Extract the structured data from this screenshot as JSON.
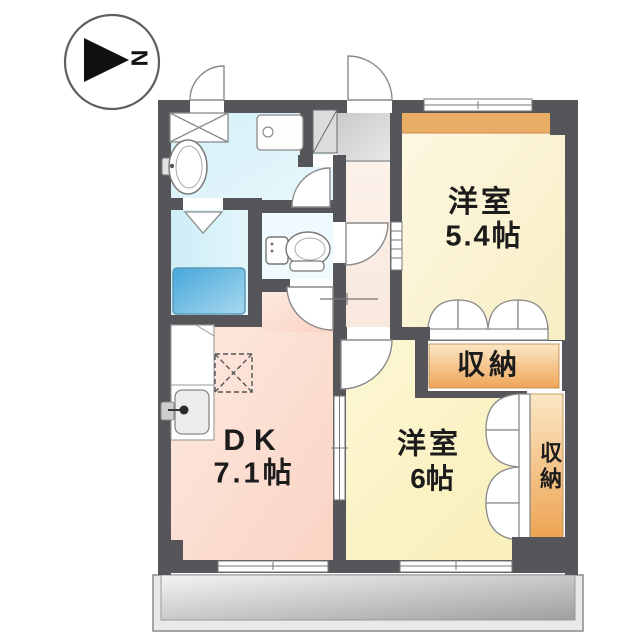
{
  "plan_type": "apartment-floor-plan",
  "compass": {
    "north_label": "N"
  },
  "rooms": {
    "western_room_a": {
      "name": "洋室",
      "size": "5.4帖"
    },
    "western_room_b": {
      "name": "洋室",
      "size": "6帖"
    },
    "dining_kitchen": {
      "name": "DK",
      "size": "7.1帖"
    },
    "storage_between": {
      "label": "収納"
    },
    "storage_side": {
      "label": "収納"
    }
  },
  "fixtures": [
    "bathtub",
    "washbasin",
    "toilet",
    "washing-machine-pan",
    "kitchen-sink",
    "refrigerator-space",
    "shoe-cabinet",
    "closet-x"
  ],
  "colors": {
    "wall": "#56565a",
    "washroom_floor": "#d9f1f8",
    "bath_floor": "#d2eef6",
    "toilet_floor": "#eefafd",
    "dk_floor": "#fbdcce",
    "room_a_floor": "#fbf4d8",
    "room_b_floor": "#fbf2c6",
    "hall_floor": "#fbf0e8",
    "entrance_floor": "#d6d6d6",
    "accent_band": "#e9ad66",
    "storage_orange": "#f0a95c",
    "bathtub_blue": "#55aedd",
    "balcony_gray": "#c9c9c9",
    "text": "#1c1c1c"
  }
}
